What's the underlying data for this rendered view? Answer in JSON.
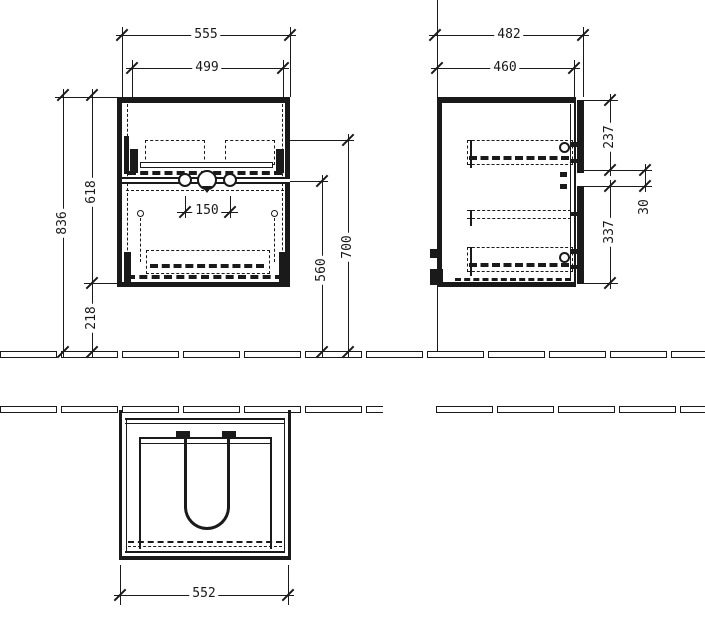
{
  "colors": {
    "line": "#1a1a1a",
    "background": "#ffffff"
  },
  "front_view": {
    "overall_width": "555",
    "inner_width": "499",
    "total_height": "836",
    "carcass_height": "618",
    "bottom_clearance": "218",
    "drain_spacing": "150",
    "rail_height": "560",
    "interior_height": "700"
  },
  "side_view": {
    "overall_depth": "482",
    "carcass_depth": "460",
    "upper_front_height": "237",
    "front_gap": "30",
    "lower_front_height": "337"
  },
  "bottom_view": {
    "width": "552"
  }
}
